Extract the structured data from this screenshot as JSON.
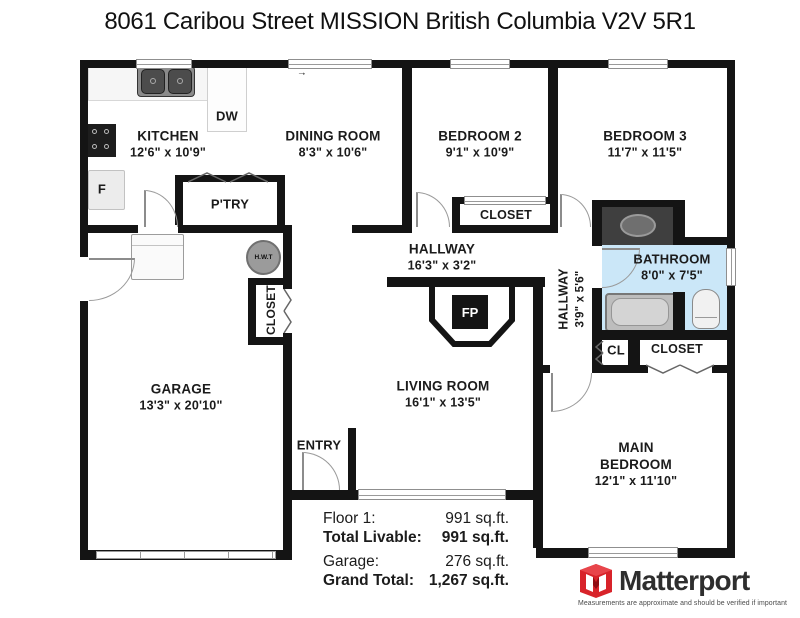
{
  "title": "8061 Caribou Street MISSION British Columbia V2V 5R1",
  "rooms": {
    "kitchen": {
      "name": "KITCHEN",
      "dims": "12'6\" x 10'9\""
    },
    "dining": {
      "name": "DINING ROOM",
      "dims": "8'3\" x 10'6\""
    },
    "bedroom2": {
      "name": "BEDROOM 2",
      "dims": "9'1\" x 10'9\""
    },
    "bedroom3": {
      "name": "BEDROOM 3",
      "dims": "11'7\" x 11'5\""
    },
    "hallway": {
      "name": "HALLWAY",
      "dims": "16'3\" x 3'2\""
    },
    "hallway2": {
      "name": "HALLWAY",
      "dims": "3'9\" x 5'6\""
    },
    "bathroom": {
      "name": "BATHROOM",
      "dims": "8'0\" x 7'5\""
    },
    "garage": {
      "name": "GARAGE",
      "dims": "13'3\" x 20'10\""
    },
    "living": {
      "name": "LIVING ROOM",
      "dims": "16'1\" x 13'5\""
    },
    "main_bedroom": {
      "line1": "MAIN",
      "line2": "BEDROOM",
      "dims": "12'1\" x 11'10\""
    }
  },
  "labels": {
    "pantry": "P'TRY",
    "dw": "DW",
    "fridge": "F",
    "hwt": "H.W.T",
    "fp": "FP",
    "entry": "ENTRY",
    "cl": "CL",
    "closet_bed2": "CLOSET",
    "closet_garage": "CLOSET",
    "closet_main": "CLOSET",
    "slider_arrow": "→"
  },
  "stats": {
    "rows": [
      {
        "label": "Floor 1:",
        "value": "991 sq.ft."
      },
      {
        "label": "Total Livable:",
        "value": "991 sq.ft."
      },
      {
        "label": "Garage:",
        "value": "276 sq.ft."
      },
      {
        "label": "Grand Total:",
        "value": "1,267 sq.ft."
      }
    ]
  },
  "branding": {
    "name": "Matterport",
    "tagline": "Measurements are approximate and should be verified if important"
  },
  "colors": {
    "wall": "#141414",
    "bathroom_fill": "#cbe7f8",
    "brand_red": "#d8232a"
  }
}
